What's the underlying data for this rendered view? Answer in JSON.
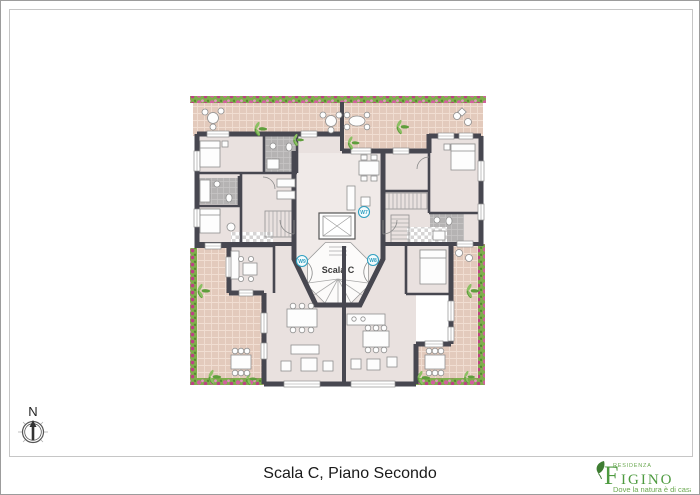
{
  "caption": {
    "text": "Scala C, Piano Secondo"
  },
  "plan": {
    "stairwell_label": "Scala C",
    "unit_badges": [
      {
        "position": "top",
        "label": "W7"
      },
      {
        "position": "left",
        "label": "W9"
      },
      {
        "position": "right",
        "label": "W8"
      }
    ]
  },
  "compass": {
    "north_label": "N"
  },
  "logo": {
    "residenza": "RESIDENZA",
    "name_initial": "F",
    "name_rest": "IGINO",
    "tagline": "Dove la natura è di casa"
  },
  "colors": {
    "wall": "#474750",
    "terrace": "#e3cabc",
    "floor": "#e9e1df",
    "hall_floor": "#f0eae8",
    "bath": "#b5b3b3",
    "flower_pink": "#d2609e",
    "flower_green": "#7fae4c",
    "badge": "#2f9fc0",
    "logo_green": "#4e9b40",
    "caption_text": "#1a1a1a",
    "frame_gray": "#c6c6c6",
    "border_gray": "#9c9c9c"
  }
}
